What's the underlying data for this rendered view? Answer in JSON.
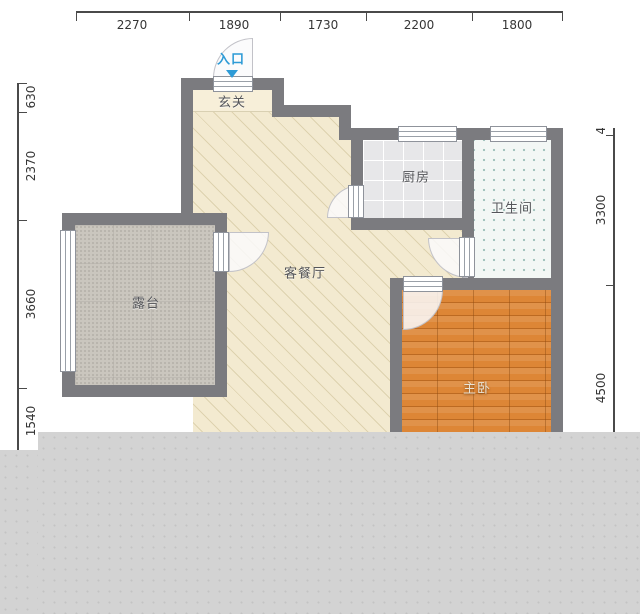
{
  "title": "floor-plan",
  "dimensions": {
    "top": [
      "2270",
      "1890",
      "1730",
      "2200",
      "1800"
    ],
    "left": [
      "630",
      "2370",
      "3660",
      "1540"
    ],
    "right": [
      "470",
      "3300",
      "4500"
    ]
  },
  "rooms": {
    "entry": "入口",
    "foyer": "玄关",
    "kitchen": "厨房",
    "bathroom": "卫生间",
    "living_dining": "客餐厅",
    "terrace": "露台",
    "master_bedroom": "主卧"
  },
  "colors": {
    "wall": "#7b7b7f",
    "living_floor": "#f3ead0",
    "foyer_floor": "#f7efd9",
    "kitchen_floor": "#e7e7e9",
    "bathroom_floor": "#f3f7f5",
    "terrace_floor": "#cac6be",
    "bedroom_floor": "#dd8636",
    "entry_accent": "#2e9bd6",
    "dimension_text": "#353535",
    "overlay_gray": "#d3d3d3"
  }
}
